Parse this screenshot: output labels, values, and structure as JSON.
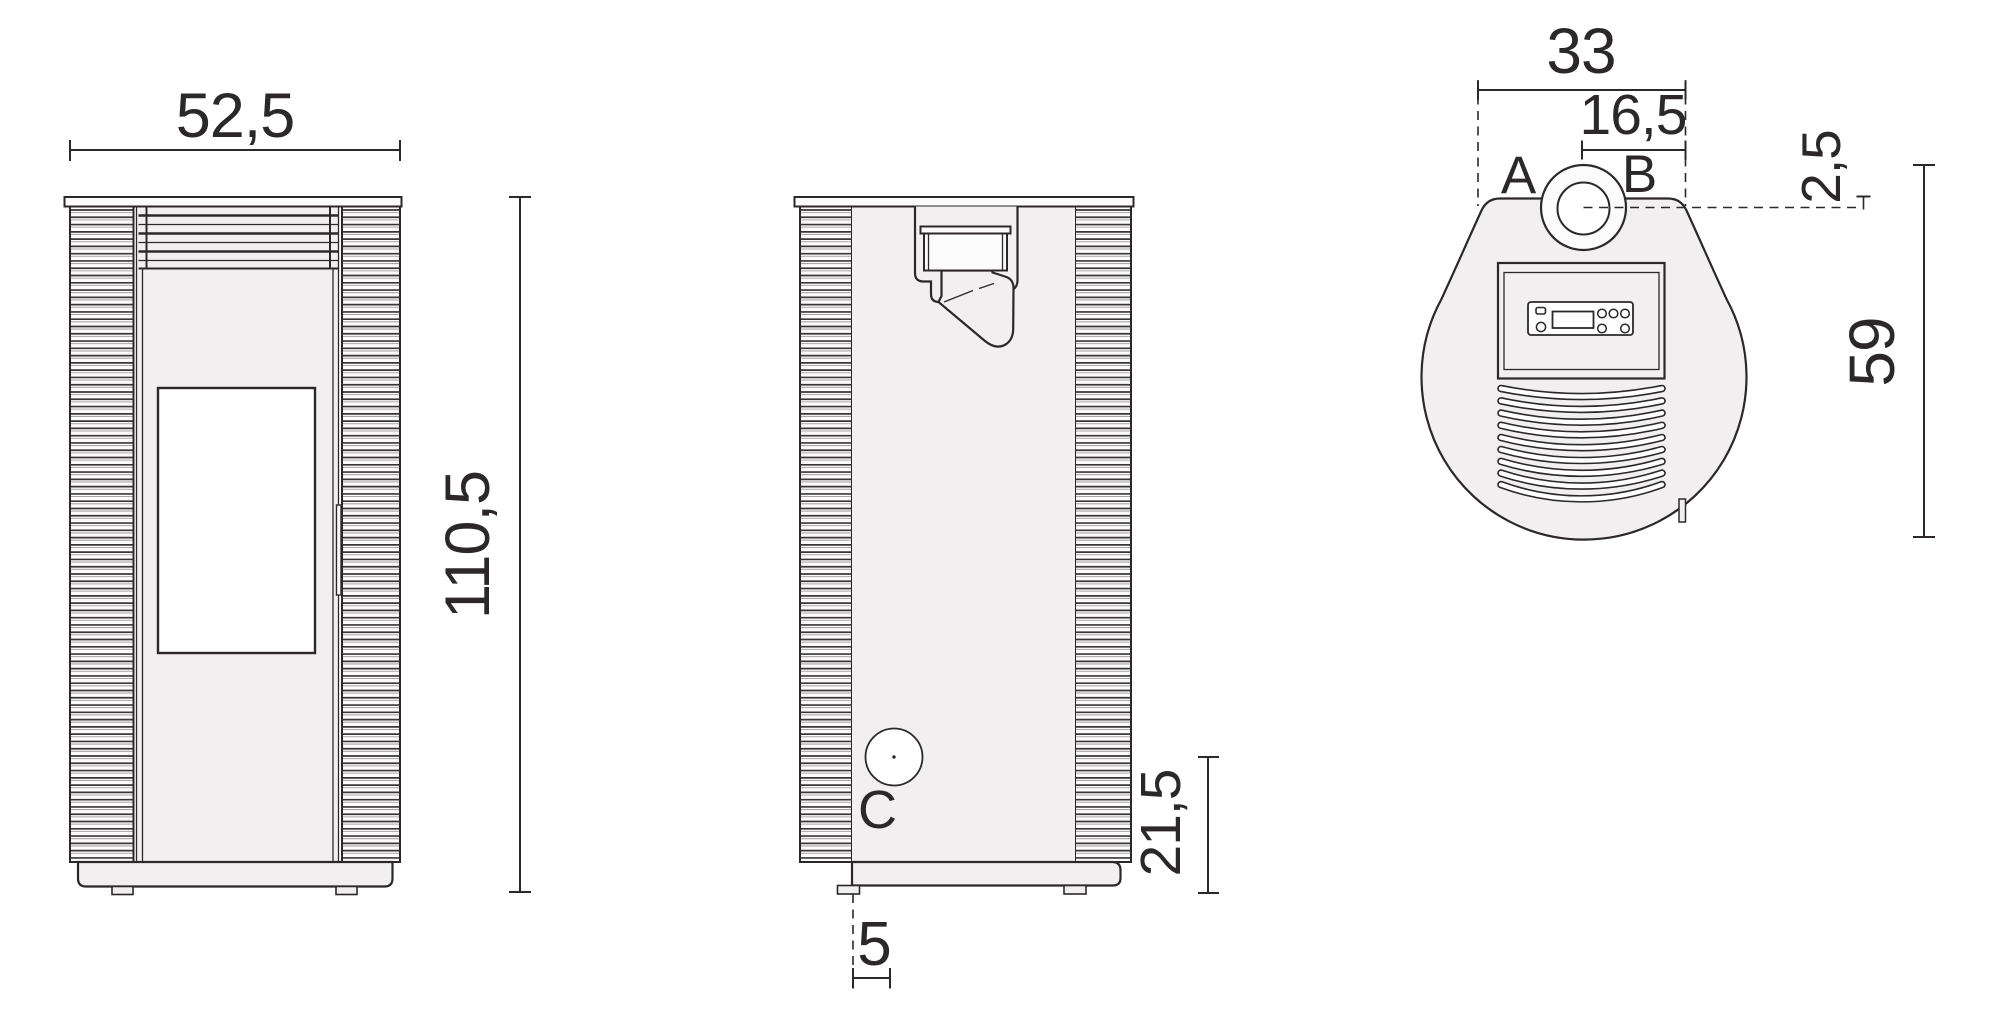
{
  "drawing": {
    "front_view": {
      "width_label": "52,5",
      "height_label": "110,5"
    },
    "side_view": {
      "port_label": "C",
      "port_height_label": "21,5",
      "foot_offset_label": "5"
    },
    "top_view": {
      "back_width_label": "33",
      "flue_offset_label": "16,5",
      "connection_a_label": "A",
      "connection_b_label": "B",
      "flue_edge_label": "2,5",
      "depth_label": "59"
    }
  },
  "colors": {
    "ink": "#2c2829",
    "ink_soft": "#3a3637",
    "rib_shadow": "#aaa6a7",
    "panel": "#f1eff0",
    "rib_bg": "#fcfbfb",
    "white": "#ffffff",
    "background": "#ffffff"
  }
}
